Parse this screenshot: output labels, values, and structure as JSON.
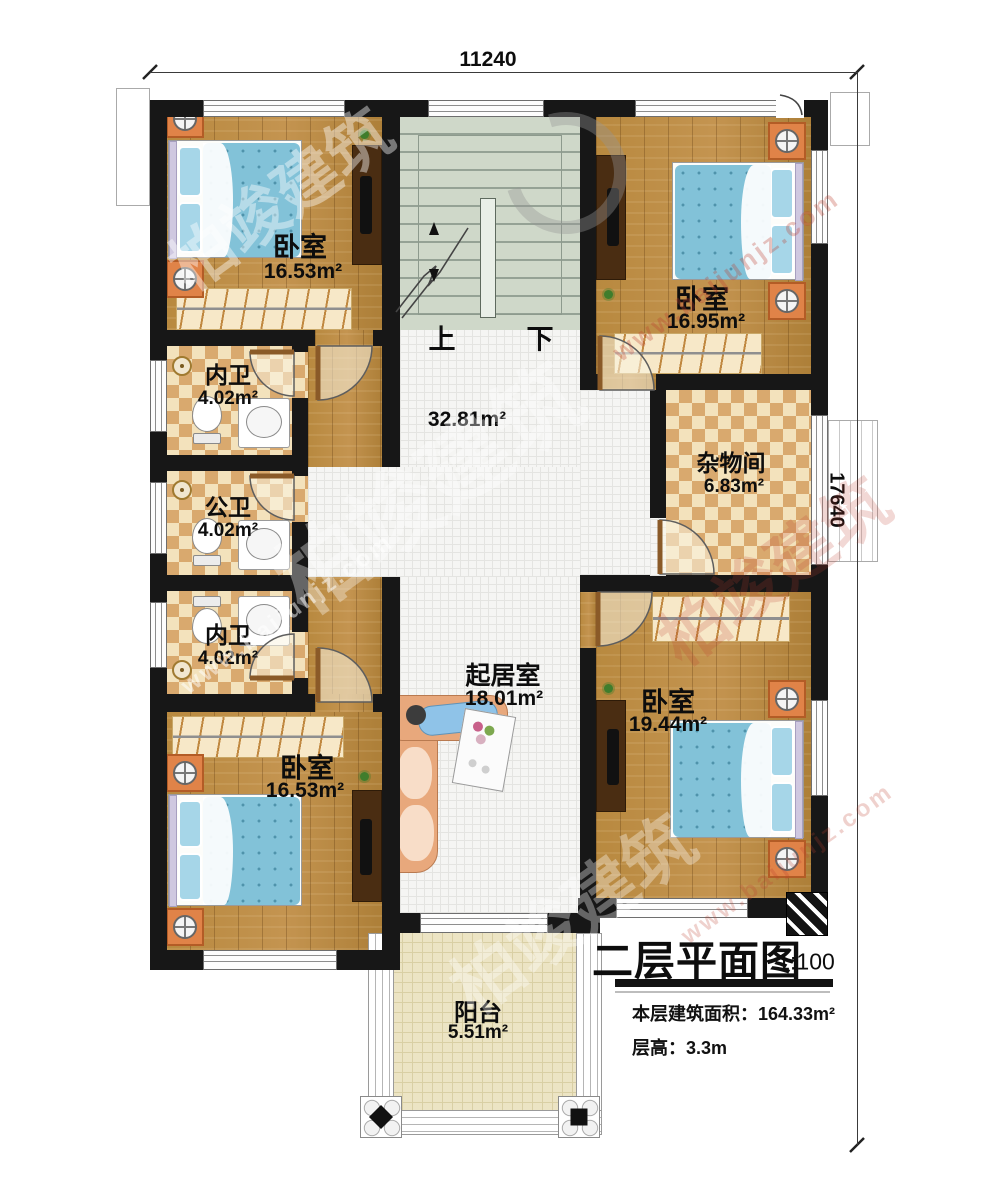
{
  "dimensions": {
    "width_top": "11240",
    "height_right": "17640"
  },
  "stairs": {
    "up_label": "上",
    "down_label": "下"
  },
  "hall": {
    "area": "32.81m²"
  },
  "rooms": {
    "bedroom_top_left": {
      "name": "卧室",
      "area": "16.53m²"
    },
    "bedroom_top_right": {
      "name": "卧室",
      "area": "16.95m²"
    },
    "bath_inner_top": {
      "name": "内卫",
      "area": "4.02m²"
    },
    "bath_public": {
      "name": "公卫",
      "area": "4.02m²"
    },
    "bath_inner_bottom": {
      "name": "内卫",
      "area": "4.02m²"
    },
    "storage": {
      "name": "杂物间",
      "area": "6.83m²"
    },
    "living": {
      "name": "起居室",
      "area": "18.01m²"
    },
    "bedroom_bottom_left": {
      "name": "卧室",
      "area": "16.53m²"
    },
    "bedroom_bottom_right": {
      "name": "卧室",
      "area": "19.44m²"
    },
    "balcony": {
      "name": "阳台",
      "area": "5.51m²"
    }
  },
  "title_block": {
    "title": "二层平面图",
    "scale": "1:100",
    "area_label": "本层建筑面积：",
    "area_value": "164.33m²",
    "height_label": "层高：",
    "height_value": "3.3m"
  },
  "watermark": {
    "brand": "柏竣建筑",
    "site": "www.baijunjz.com"
  },
  "colors": {
    "wall": "#171717",
    "wood_floor": "#b5873f",
    "bath_tile_dark": "#d9a96e",
    "bath_tile_light": "#f3e2bc",
    "stair": "#cfd8c9",
    "balcony_floor": "#ece4c4",
    "bed_blue": "#82c2d8",
    "nightstand_orange": "#e08348"
  }
}
